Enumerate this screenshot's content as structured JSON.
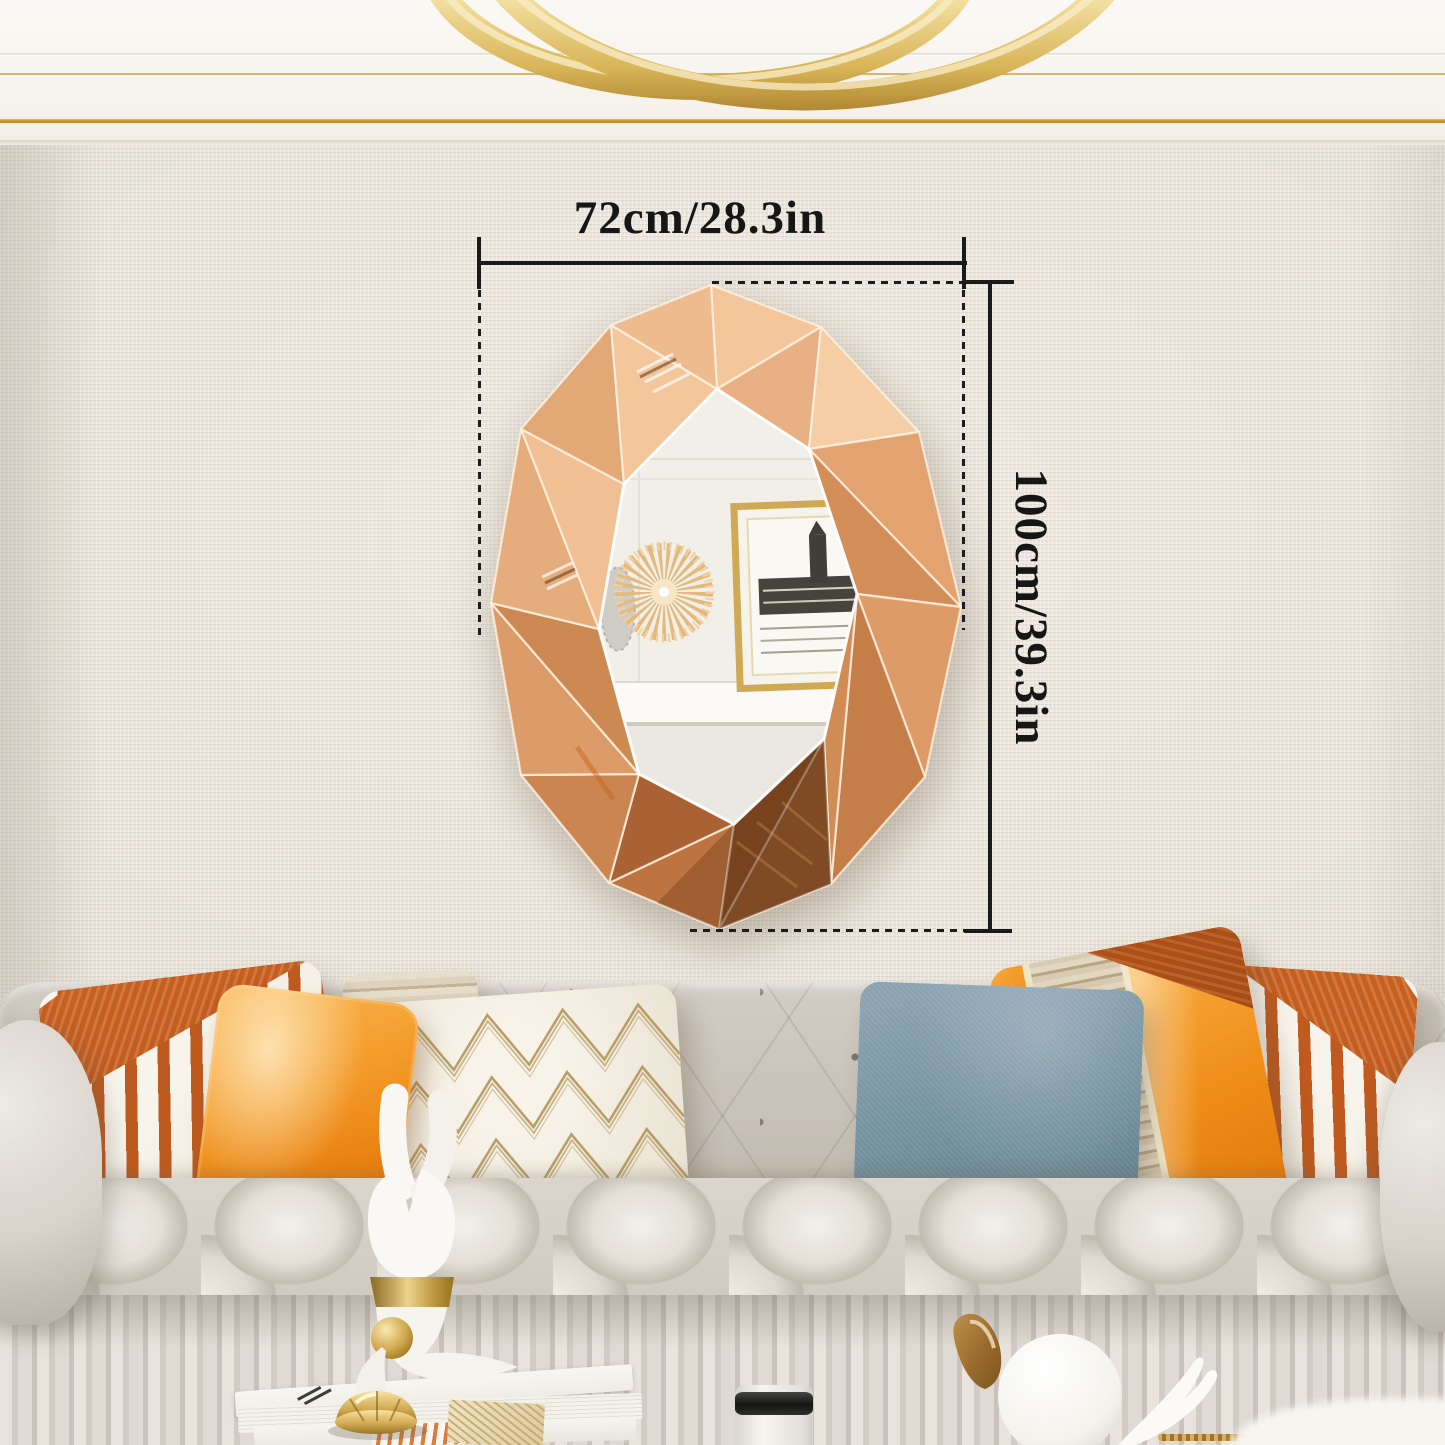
{
  "annotations": {
    "width_label": "72cm/28.3in",
    "height_label": "100cm/39.3in"
  },
  "palette": {
    "dimension_line": "#1a1a1a",
    "wall_linen": "#e7e2d8",
    "ceiling_white": "#f8f5f0",
    "ceiling_gold_trim": "#c69a3f",
    "ring_light_gold": "#d9b558",
    "mirror_rose_gold_light": "#f4c89e",
    "mirror_rose_gold_mid": "#d99a6a",
    "mirror_rose_gold_dark": "#a65e30",
    "mirror_bevel_highlight": "#fff2e2",
    "mirror_glass_reflection": "#f2efe9",
    "sofa_gray": "#cdc7be",
    "pillow_rust_stripe": "#bf5a1f",
    "pillow_orange_satin": "#ef8d18",
    "pillow_blue": "#73909f",
    "pillow_gold_zigzag": "#b2955a",
    "figurine_white": "#f8f6f2",
    "figurine_gold": "#caa24a"
  }
}
